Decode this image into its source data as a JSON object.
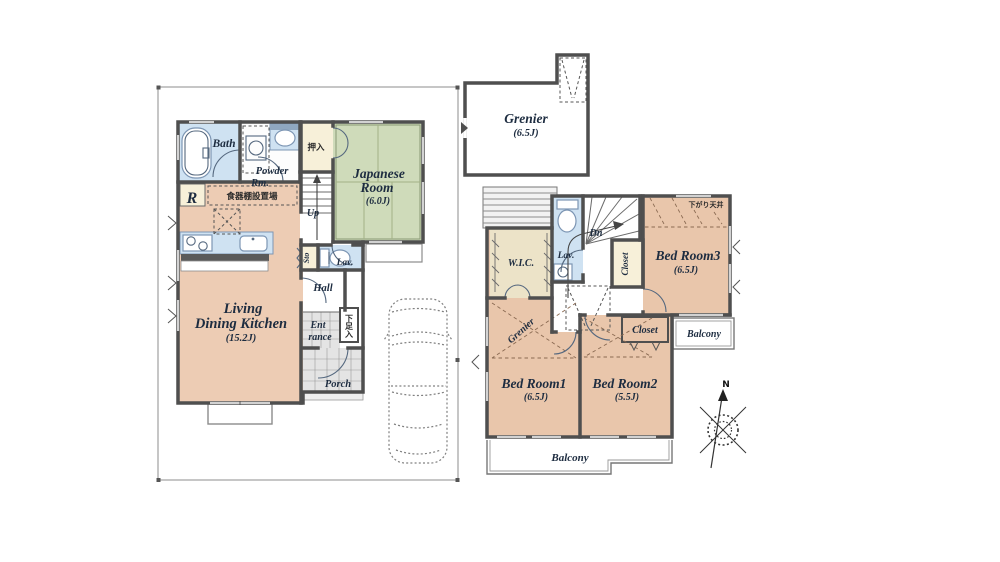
{
  "first_floor": {
    "labels": {
      "bath": "Bath",
      "powder_line1": "Powder",
      "powder_line2": "Rm.",
      "refrigerator": "R",
      "dish_cabinet_area": "食器棚設置場",
      "oshiire_closet": "押入",
      "japanese_room_line1": "Japanese",
      "japanese_room_line2": "Room",
      "japanese_room_size": "(6.0J)",
      "stairs_up": "Up",
      "storage": "Sto",
      "lavatory": "Lav.",
      "hall": "Hall",
      "entrance_line1": "Ent",
      "entrance_line2": "rance",
      "shoe_cabinet": "下足入",
      "porch": "Porch",
      "ldk_line1": "Living",
      "ldk_line2": "Dining Kitchen",
      "ldk_size": "(15.2J)"
    }
  },
  "second_floor": {
    "labels": {
      "wic": "W.I.C.",
      "lavatory": "Lav.",
      "stairs_down": "Dn",
      "closet_bedroom3": "Closet",
      "bedroom3": "Bed Room3",
      "bedroom3_size": "(6.5J)",
      "lowered_ceiling": "下がり天井",
      "closet_bedroom2": "Closet",
      "balcony_side": "Balcony",
      "grenier_above": "Grenier",
      "bedroom1": "Bed Room1",
      "bedroom1_size": "(6.5J)",
      "bedroom2": "Bed Room2",
      "bedroom2_size": "(5.5J)",
      "balcony_main": "Balcony"
    }
  },
  "attic": {
    "labels": {
      "grenier": "Grenier",
      "grenier_size": "(6.5J)"
    }
  },
  "compass": {
    "north": "N"
  },
  "colors": {
    "wall": "#4f4f4f",
    "room_salmon": "#ebc9b0",
    "tatami_green": "#cfdbba",
    "wet_blue": "#cfe2f2",
    "closet_cream": "#f7f0d9",
    "wic_cream": "#ece3c8",
    "tile_gray": "#e4e4e4"
  }
}
